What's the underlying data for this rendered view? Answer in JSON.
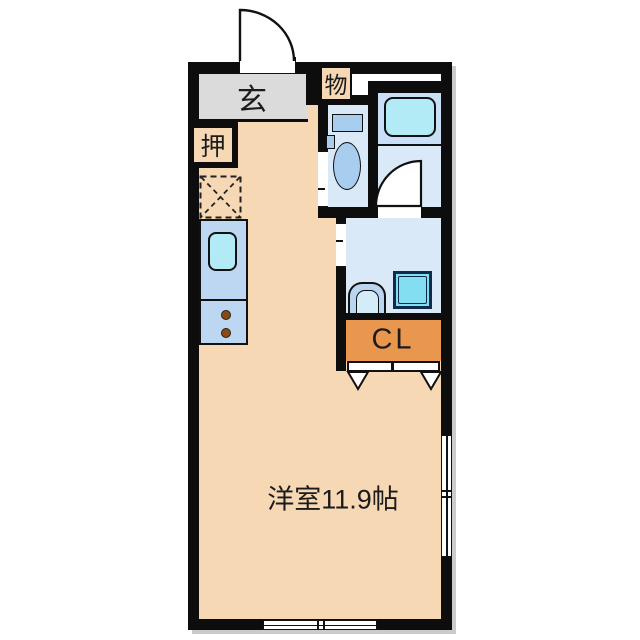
{
  "floorplan": {
    "type": "japanese-apartment-floor-plan",
    "labels": {
      "entrance": "玄",
      "oshiire_closet": "押",
      "storage": "物",
      "closet": "CL",
      "main_room": "洋室11.9帖"
    },
    "colors": {
      "wall": "#0d0d0d",
      "room_floor_tan": "#f6d8b4",
      "entrance_floor_gray": "#dbdbdb",
      "wet_area_floor_blue": "#d9e9f8",
      "bath_upper_blue": "#c8dff5",
      "bathtub_cyan": "#b2ebf6",
      "washer_pan_cyan": "#84def1",
      "kitchen_counter_blue": "#bdd6f2",
      "fixture_blue": "#a9cdef",
      "closet_orange": "#e9964e",
      "burner_brown": "#8a4a12"
    }
  }
}
